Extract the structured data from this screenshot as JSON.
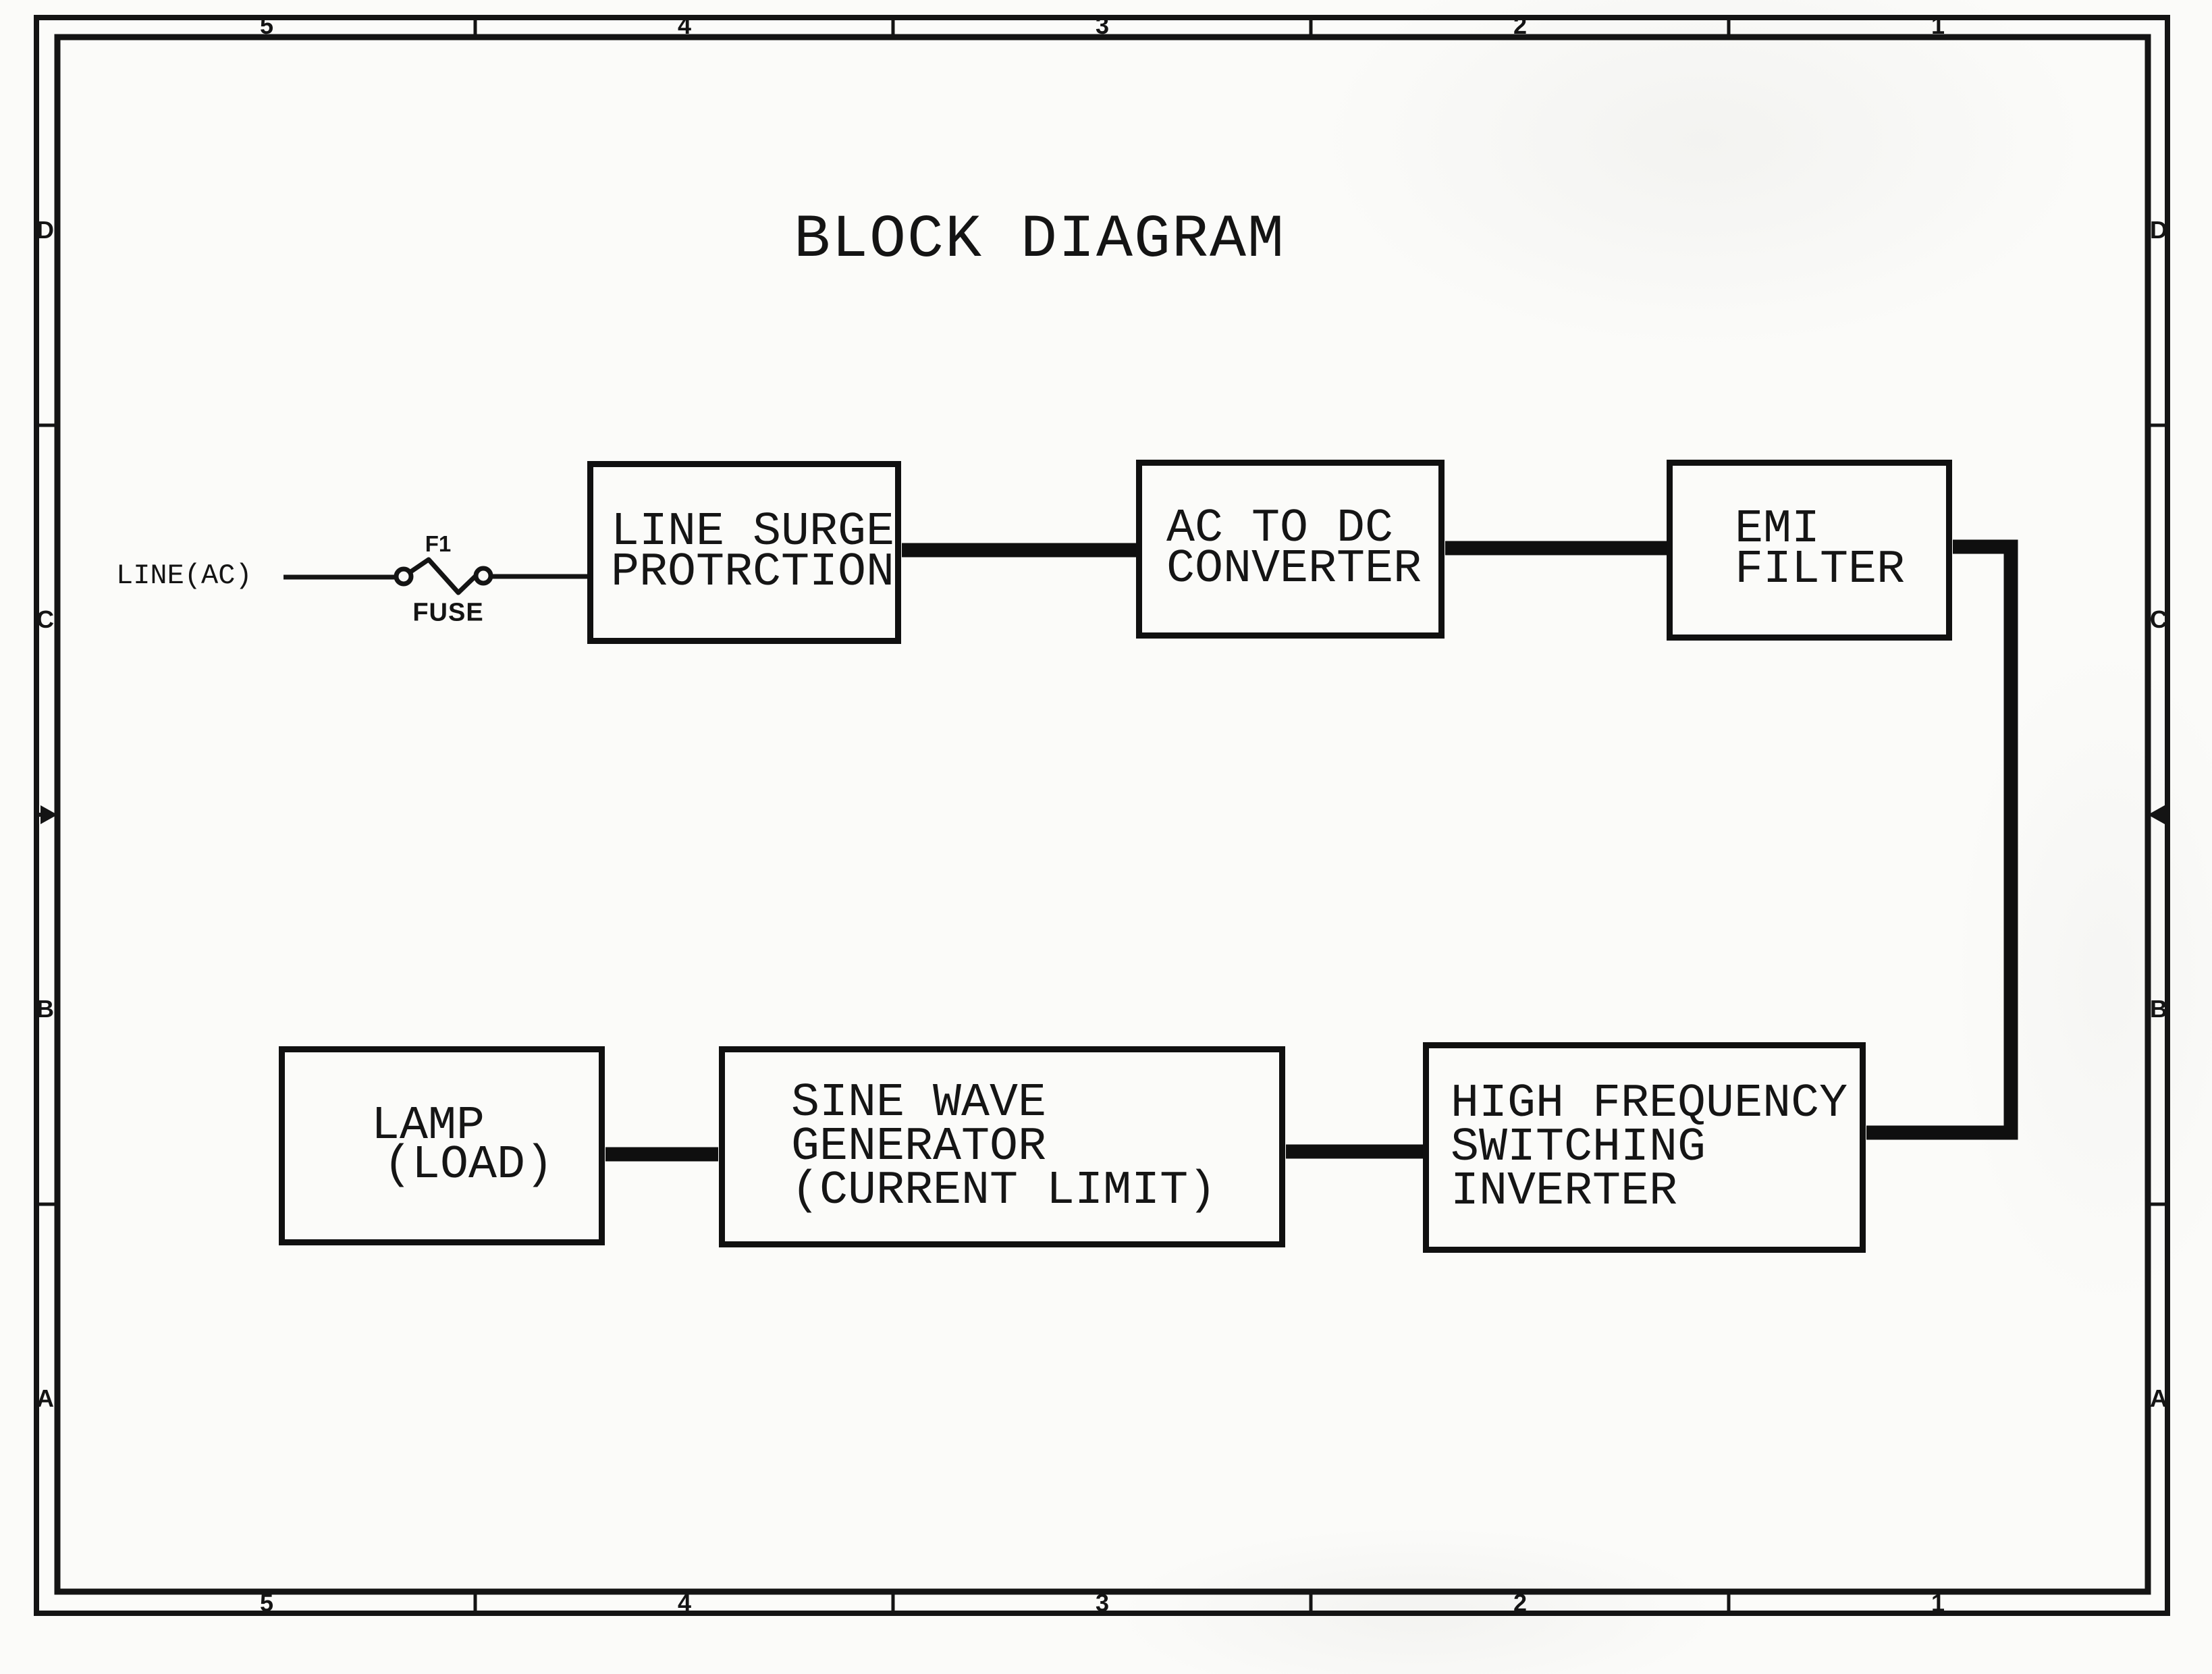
{
  "colors": {
    "ink": "#141414",
    "paper": "#fbfbf9"
  },
  "title": "BLOCK DIAGRAM",
  "frame": {
    "top_zones": [
      "5",
      "4",
      "3",
      "2",
      "1"
    ],
    "bottom_zones": [
      "5",
      "4",
      "3",
      "2",
      "1"
    ],
    "left_zones": [
      "D",
      "C",
      "B",
      "A"
    ],
    "right_zones": [
      "D",
      "C",
      "B",
      "A"
    ]
  },
  "input": {
    "line_label": "LINE(AC)",
    "fuse_designator": "F1",
    "fuse_label": "FUSE"
  },
  "blocks": [
    {
      "name": "line-surge-protection",
      "lines": [
        "LINE SURGE",
        "PROTRCTION"
      ]
    },
    {
      "name": "ac-to-dc-converter",
      "lines": [
        "AC TO DC",
        "CONVERTER"
      ]
    },
    {
      "name": "emi-filter",
      "lines": [
        "EMI",
        "FILTER"
      ]
    },
    {
      "name": "high-frequency-switching-inverter",
      "lines": [
        "HIGH FREQUENCY",
        "SWITCHING",
        "INVERTER"
      ]
    },
    {
      "name": "sine-wave-generator-current-limit",
      "lines": [
        "SINE WAVE",
        "GENERATOR",
        "(CURRENT LIMIT)"
      ]
    },
    {
      "name": "lamp-load",
      "lines": [
        "LAMP",
        "(LOAD)"
      ]
    }
  ]
}
